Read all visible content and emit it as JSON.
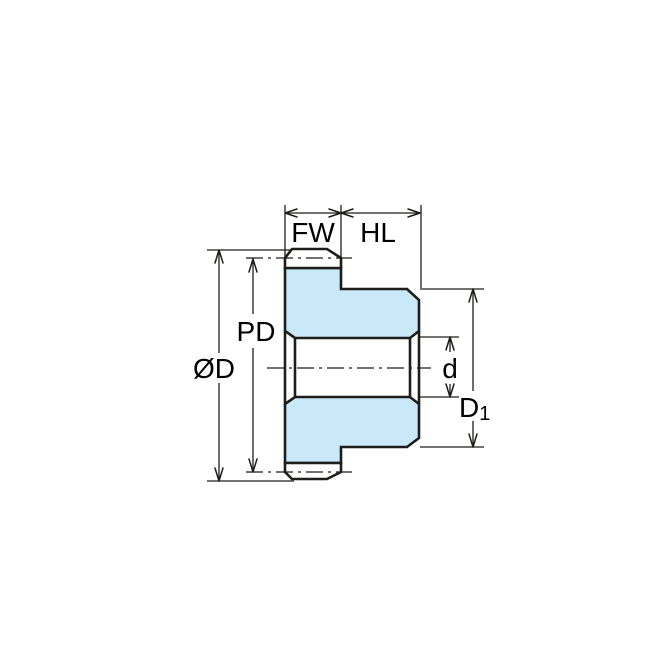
{
  "diagram": {
    "labels": {
      "face_width": "FW",
      "hub_length": "HL",
      "pitch_diameter": "PD",
      "outside_diameter": "ØD",
      "bore_diameter": "d",
      "hub_diameter_main": "D",
      "hub_diameter_sub": "1"
    },
    "colors": {
      "gear_fill": "#c9e8f8",
      "line_color": "#1d1d1b",
      "background": "#ffffff"
    }
  }
}
